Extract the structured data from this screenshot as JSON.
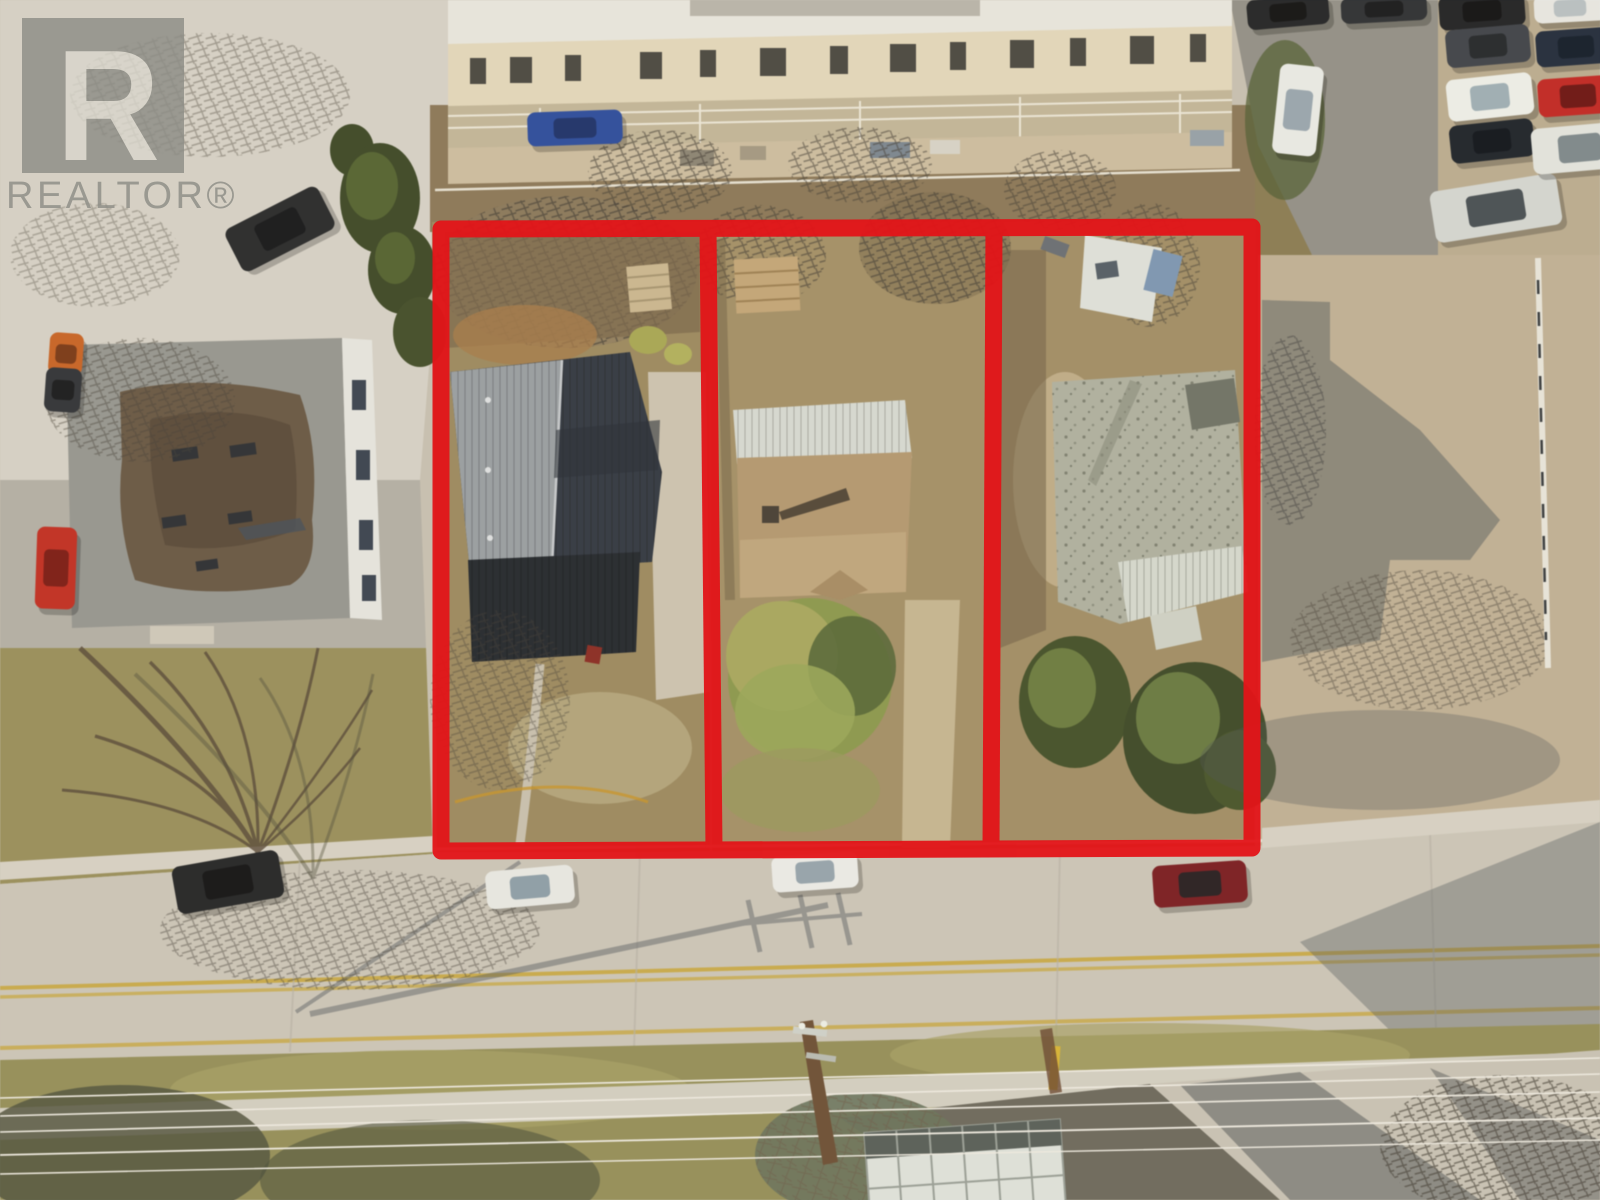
{
  "image_type": "aerial-drone-photo-real-estate-listing",
  "watermark": {
    "logo_letter": "R",
    "brand_text": "REALTOR®",
    "color": "#8d8d86"
  },
  "boundary": {
    "color": "#e31418",
    "stroke_width": 17,
    "opacity": 0.95,
    "outer": [
      [
        441,
        229
      ],
      [
        1252,
        227
      ],
      [
        1252,
        848
      ],
      [
        441,
        851
      ]
    ],
    "dividers": [
      [
        [
          708,
          229
        ],
        [
          714,
          849
        ]
      ],
      [
        [
          994,
          227
        ],
        [
          991,
          848
        ]
      ]
    ],
    "lot_count": 3,
    "lots": [
      {
        "name": "lot-1-west",
        "feature": "house-dark-gray-roof-with-shed"
      },
      {
        "name": "lot-2-middle",
        "feature": "house-tan-roof-large-front-bush"
      },
      {
        "name": "lot-3-east",
        "feature": "house-weathered-gray-roof-spruce-trees"
      }
    ]
  },
  "palette": {
    "road": "#ccc7bc",
    "grass": "#96915e",
    "dirt_lot": "#9d8b64",
    "gravel_lot": "#c1b299",
    "roof_dark": "#343b47",
    "roof_sunlit": "#9aa0a6",
    "roof_tan": "#b49a74",
    "roof_weathered": "#b0b2a4",
    "conifer": "#3f4b2b",
    "centerline_yellow": "#c9a83e",
    "shadow": "#565c63"
  },
  "vehicles": [
    {
      "name": "suv-dark-street-left",
      "cx": 228,
      "cy": 882,
      "w": 108,
      "h": 48,
      "rot": -10,
      "body": "#26282b",
      "glass": "#15161a"
    },
    {
      "name": "car-white-street-1",
      "cx": 530,
      "cy": 887,
      "w": 88,
      "h": 38,
      "rot": -5,
      "body": "#e9eae6",
      "glass": "#8fa0ac"
    },
    {
      "name": "car-white-street-2",
      "cx": 815,
      "cy": 872,
      "w": 86,
      "h": 36,
      "rot": -4,
      "body": "#ecedeb",
      "glass": "#97a6b0"
    },
    {
      "name": "car-red-street",
      "cx": 1200,
      "cy": 884,
      "w": 94,
      "h": 42,
      "rot": -4,
      "body": "#7c2026",
      "glass": "#2a2226"
    },
    {
      "name": "suv-dark-topleft",
      "cx": 280,
      "cy": 229,
      "w": 104,
      "h": 48,
      "rot": -27,
      "body": "#2a2c30",
      "glass": "#191b1f"
    },
    {
      "name": "car-orange-left",
      "cx": 66,
      "cy": 354,
      "w": 34,
      "h": 42,
      "rot": 4,
      "body": "#c8662a",
      "glass": "#7c3c1c"
    },
    {
      "name": "car-dark-left",
      "cx": 63,
      "cy": 390,
      "w": 36,
      "h": 44,
      "rot": 4,
      "body": "#33363c",
      "glass": "#1c1e22"
    },
    {
      "name": "car-red-left",
      "cx": 56,
      "cy": 568,
      "w": 40,
      "h": 82,
      "rot": 2,
      "body": "#c23227",
      "glass": "#7e1f1a"
    },
    {
      "name": "car-blue-tarp",
      "cx": 575,
      "cy": 128,
      "w": 95,
      "h": 34,
      "rot": -2,
      "body": "#2f4fa0",
      "glass": "#20356e"
    },
    {
      "name": "car-white-angled-lot",
      "cx": 1298,
      "cy": 110,
      "w": 44,
      "h": 90,
      "rot": 6,
      "body": "#eaece8",
      "glass": "#9aa8b2"
    },
    {
      "name": "car-dark-top-a",
      "cx": 1288,
      "cy": 12,
      "w": 82,
      "h": 30,
      "rot": -5,
      "body": "#25272b",
      "glass": "#141518"
    },
    {
      "name": "car-dark-top-b",
      "cx": 1384,
      "cy": 9,
      "w": 86,
      "h": 26,
      "rot": -3,
      "body": "#303338",
      "glass": "#1b1d21"
    },
    {
      "name": "car-dark-row-1",
      "cx": 1482,
      "cy": 11,
      "w": 86,
      "h": 34,
      "rot": -4,
      "body": "#232529",
      "glass": "#131417"
    },
    {
      "name": "car-gray-row-2",
      "cx": 1488,
      "cy": 46,
      "w": 84,
      "h": 38,
      "rot": -5,
      "body": "#41464e",
      "glass": "#262a30"
    },
    {
      "name": "car-white-row-3",
      "cx": 1490,
      "cy": 97,
      "w": 86,
      "h": 42,
      "rot": -6,
      "body": "#eef0ec",
      "glass": "#9fb0b8"
    },
    {
      "name": "car-navy-row-4",
      "cx": 1492,
      "cy": 141,
      "w": 84,
      "h": 38,
      "rot": -6,
      "body": "#20262f",
      "glass": "#121720"
    },
    {
      "name": "truck-silver-row-5",
      "cx": 1496,
      "cy": 208,
      "w": 128,
      "h": 52,
      "rot": -9,
      "body": "#d5d8d5",
      "glass": "#4a5258"
    },
    {
      "name": "car-white-corner",
      "cx": 1570,
      "cy": 8,
      "w": 72,
      "h": 28,
      "rot": -3,
      "body": "#e8e9e5",
      "glass": "#b9c2c6"
    },
    {
      "name": "car-navy-right",
      "cx": 1576,
      "cy": 47,
      "w": 80,
      "h": 36,
      "rot": -4,
      "body": "#242e40",
      "glass": "#15202e"
    },
    {
      "name": "car-red-right",
      "cx": 1578,
      "cy": 96,
      "w": 80,
      "h": 38,
      "rot": -4,
      "body": "#c22a28",
      "glass": "#6e1717"
    },
    {
      "name": "van-white-right",
      "cx": 1580,
      "cy": 148,
      "w": 96,
      "h": 46,
      "rot": -5,
      "body": "#e3e5e1",
      "glass": "#7f8a90"
    }
  ]
}
